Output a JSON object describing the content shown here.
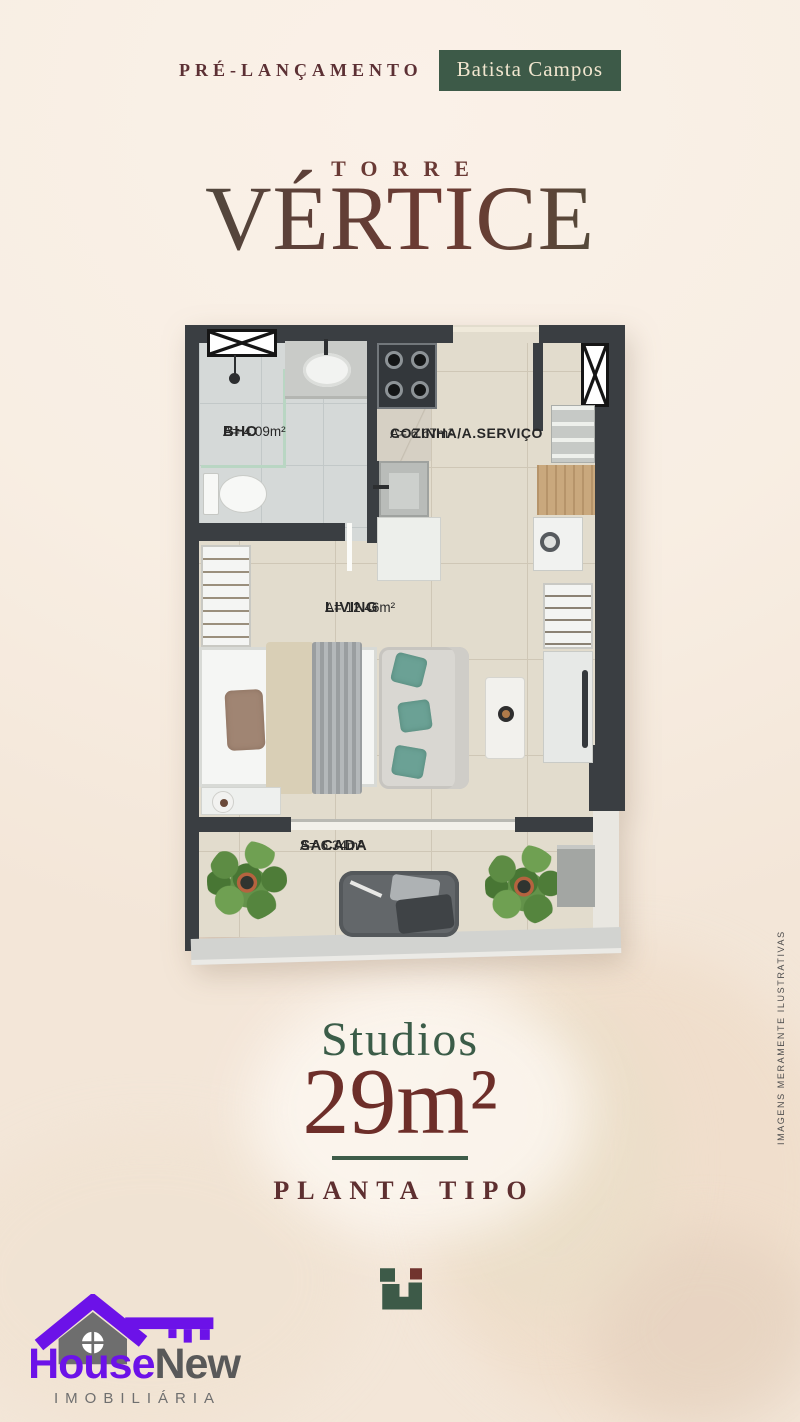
{
  "header": {
    "pre_launch": "PRÉ-LANÇAMENTO",
    "badge": "Batista Campos"
  },
  "brand": {
    "torre": "TORRE",
    "vertice": "VÉRTICE"
  },
  "floorplan": {
    "rooms": [
      {
        "name": "BHO",
        "area": "A= 4.09m²"
      },
      {
        "name": "COZINHA/A.SERVIÇO",
        "area": "A= 6.67m²"
      },
      {
        "name": "LIVING",
        "area": "A= 12.46m²"
      },
      {
        "name": "SACADA",
        "area": "A= 6.34m²"
      }
    ]
  },
  "offer": {
    "unit_type": "Studios",
    "unit_area": "29m²",
    "plan_label": "PLANTA TIPO"
  },
  "disclaimer": {
    "text": "IMAGENS MERAMENTE ILUSTRATIVAS"
  },
  "agency": {
    "name_primary": "House",
    "name_secondary": "New",
    "subtitle": "IMOBILIÁRIA"
  },
  "colors": {
    "background_cream": "#f8efe6",
    "brand_green": "#3d5a48",
    "brand_maroon": "#6d2e29",
    "wall_charcoal": "#3a3e42",
    "agency_purple": "#6c12e8",
    "teal_pillow": "#6ba195"
  }
}
